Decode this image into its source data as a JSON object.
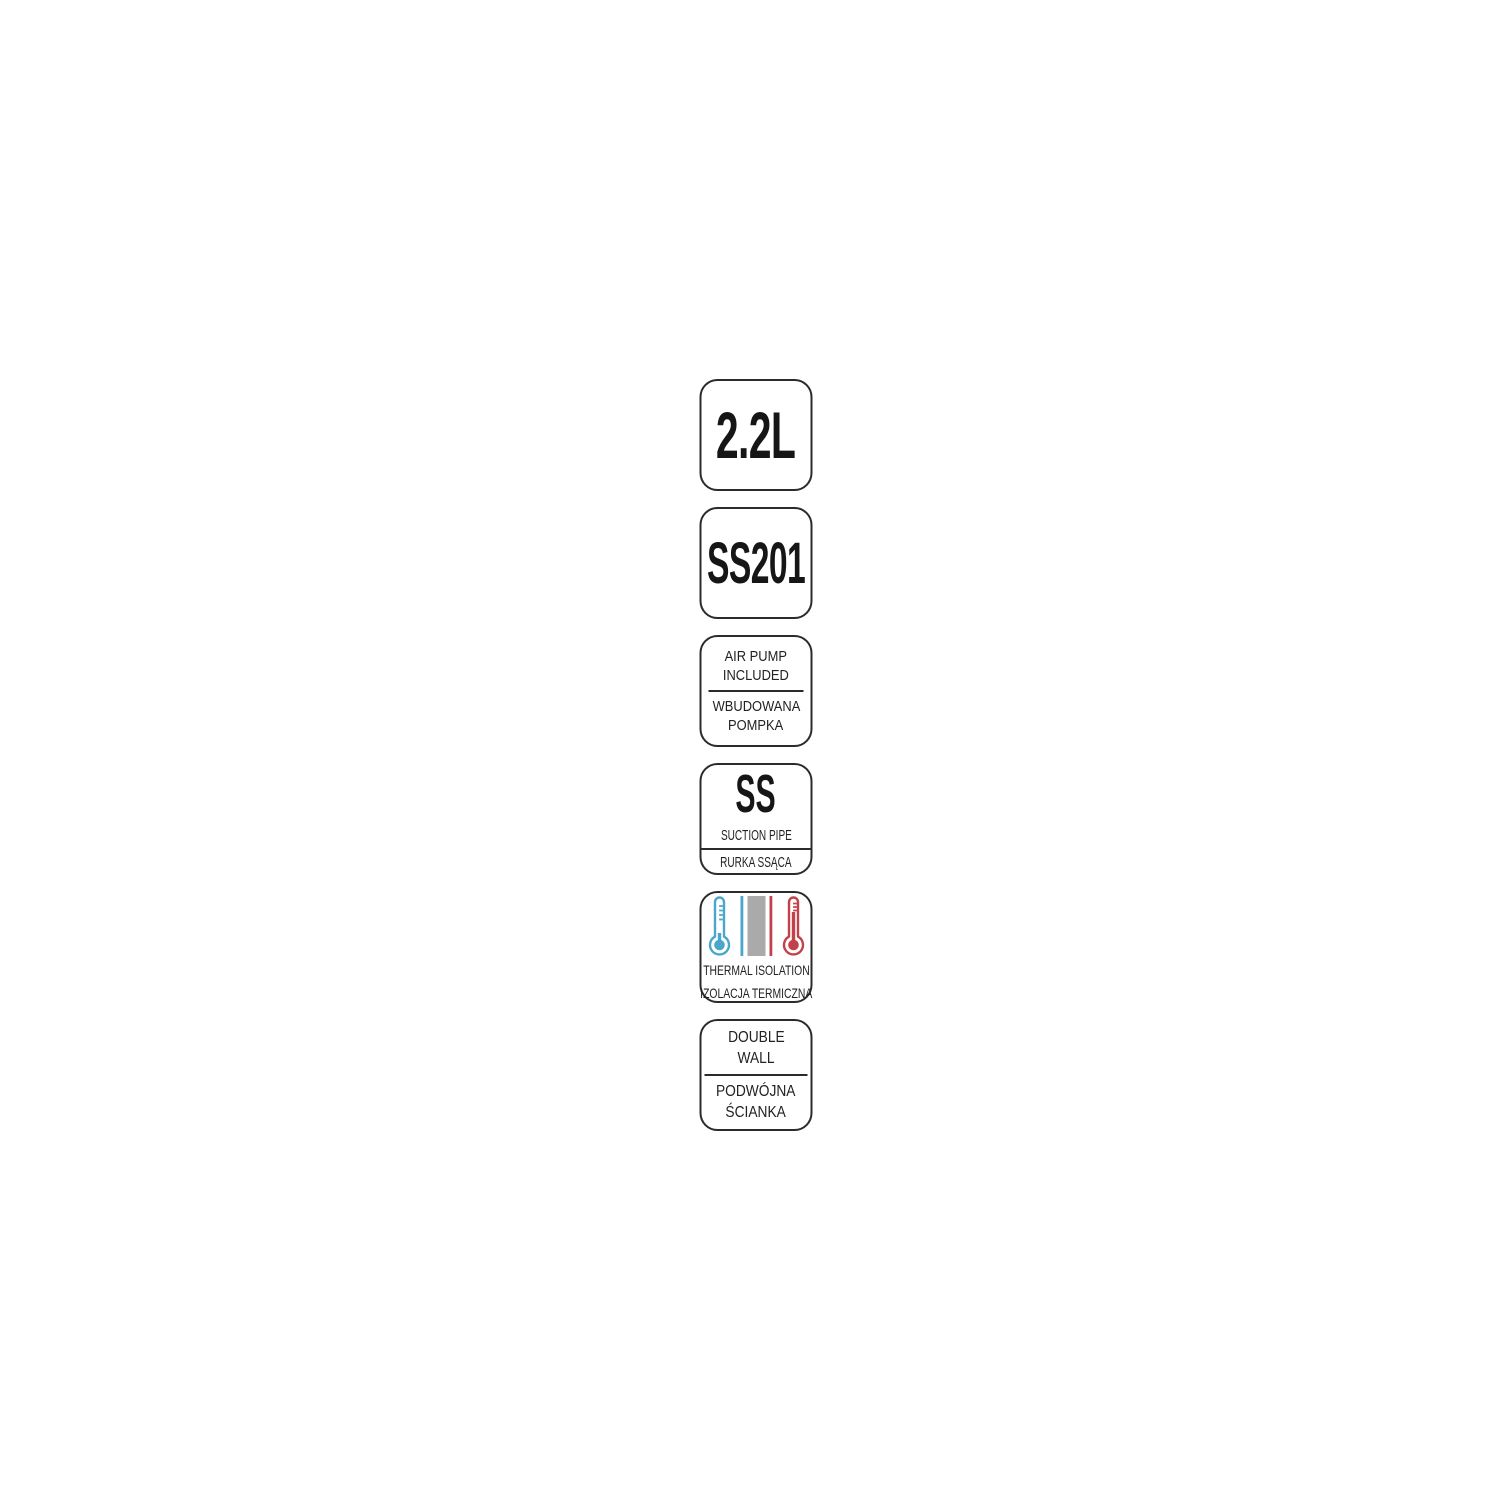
{
  "canvas": {
    "background": "#ffffff",
    "border_color": "#2b2b2b",
    "text_color": "#1d1d1d"
  },
  "badges": {
    "capacity": {
      "label": "2.2L"
    },
    "steel_grade": {
      "label": "SS201"
    },
    "air_pump": {
      "en_line1": "AIR PUMP",
      "en_line2": "INCLUDED",
      "pl_line1": "WBUDOWANA",
      "pl_line2": "POMPKA"
    },
    "suction_pipe": {
      "material": "SS",
      "en": "SUCTION PIPE",
      "pl": "RURKA SSĄCA"
    },
    "thermal_isolation": {
      "en": "THERMAL ISOLATION",
      "pl": "IZOLACJA TERMICZNA",
      "cold_color": "#4aa7cb",
      "hot_color": "#c2424b",
      "wall_color": "#aaaaaa"
    },
    "double_wall": {
      "en_line1": "DOUBLE",
      "en_line2": "WALL",
      "pl_line1": "PODWÓJNA",
      "pl_line2": "ŚCIANKA"
    }
  }
}
